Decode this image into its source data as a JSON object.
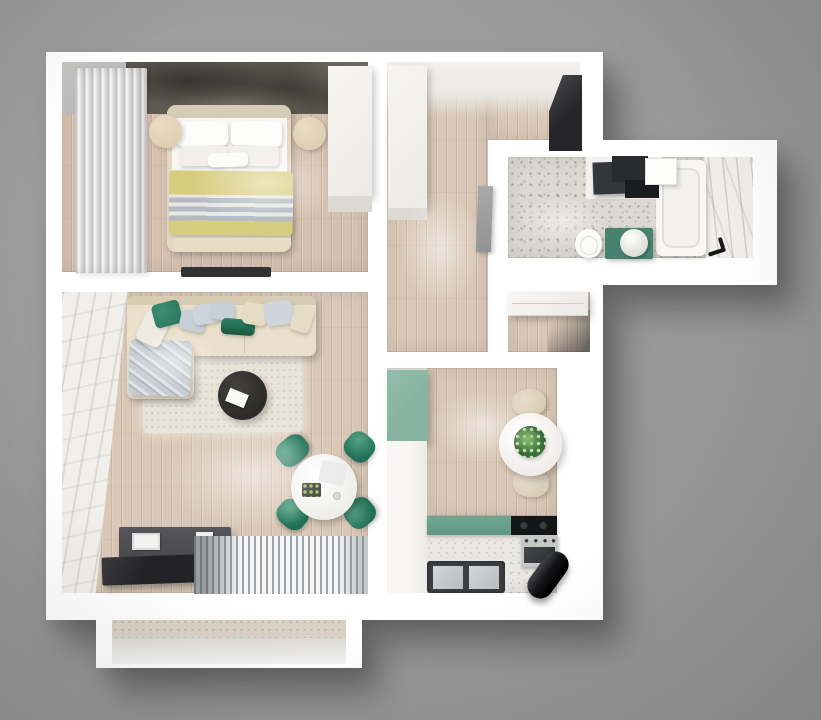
{
  "scene": {
    "description": "Top-down 3D render of a one-bedroom apartment floor plan on a gray studio background",
    "view": "top-down axonometric",
    "canvas_width_px": 821,
    "canvas_height_px": 720
  },
  "palette": {
    "bg": "#979797",
    "wall": "#ffffff",
    "wood": "#d9c8b6",
    "woodRose": "#d6c1b0",
    "accent": "#5f5a52",
    "terrazzo": "#dcd8d2",
    "kitchenFloor": "#e9e7e2",
    "marble": "#f0efeb",
    "rug": "#e9e4d9",
    "sofa": "#eadfca",
    "bedFrame": "#e2d8c4",
    "duvet": "#f7f6f3",
    "yellow": "#d8cc7e",
    "stripeGray": "#b3bac2",
    "nightstand": "#decfb3",
    "throw": "#c6ccd3",
    "pillowGreen": "#2a7a61",
    "chairGreen": "#1f6f56",
    "beigeChair": "#d8ccb6",
    "tableDark": "#2c2b2a",
    "console": "#4a4a4d",
    "tvPanel": "#232327",
    "kitchenCab": "#86b3a1",
    "counterGreen": "#5f9784",
    "cooktop": "#141517",
    "oven": "#c6c7c7",
    "sinkDark": "#3d4042",
    "cylinder": "#141518",
    "vanityGreen": "#46826f",
    "darkCabinet": "#2a2b2f",
    "entryWardrobe": "#26262a",
    "balconyFloor": "#d9d2c4"
  },
  "rooms": [
    {
      "name": "bedroom",
      "items": [
        "double-bed",
        "white-pillows",
        "yellow-striped-blanket",
        "nightstand-left",
        "nightstand-right",
        "wardrobe",
        "curtains",
        "dark-accent-wall",
        "wall-tv"
      ]
    },
    {
      "name": "hallway",
      "items": [
        "white-wardrobe",
        "leaning-door-panel"
      ]
    },
    {
      "name": "entry",
      "items": [
        "dark-wardrobe"
      ]
    },
    {
      "name": "bathroom",
      "items": [
        "bathtub",
        "black-faucet",
        "toilet",
        "green-vanity-with-round-sink",
        "dark-cabinets",
        "white-appliance-box",
        "marble-shower-wall",
        "terrazzo-floor"
      ]
    },
    {
      "name": "storage-nook",
      "items": [
        "drawer-cabinet"
      ]
    },
    {
      "name": "living-room",
      "items": [
        "corner-sofa",
        "throw-blanket",
        "accent-pillows",
        "cream-area-rug",
        "round-black-coffee-table",
        "white-book",
        "round-dining-table",
        "green-dining-chair-x4",
        "tv-console",
        "tv-panel",
        "striped-mat",
        "marble-feature-wall"
      ]
    },
    {
      "name": "kitchen",
      "items": [
        "green-tall-cabinet",
        "white-cabinet-column",
        "round-table-with-plant",
        "beige-chair-x2",
        "green-countertop",
        "black-cooktop",
        "oven",
        "double-sink",
        "black-boiler-cylinder"
      ]
    },
    {
      "name": "balcony",
      "items": [
        "open-deck"
      ]
    }
  ]
}
